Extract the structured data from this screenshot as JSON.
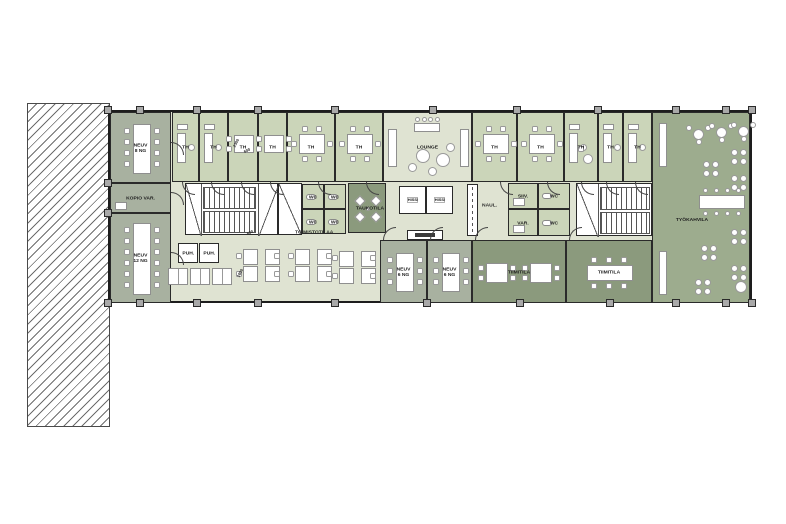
{
  "plan_title": "office-floor-plan",
  "palette": {
    "wall": "#1d1d1d",
    "meeting": "#a8b1a0",
    "office": "#cbd5b9",
    "open": "#dfe3d2",
    "dark": "#8b9a7d",
    "cafe": "#9dac8e",
    "white": "#ffffff",
    "furniture_line": "#8f8f8f"
  },
  "rooms": [
    {
      "id": "neuv-8",
      "label": "NEUV\n8 NG",
      "x": 110,
      "y": 112,
      "w": 61,
      "h": 71,
      "fill": "meeting",
      "furn": "vtable",
      "seats": 8,
      "door": "r"
    },
    {
      "id": "kopio-var",
      "label": "KOPIO VAR.",
      "x": 110,
      "y": 183,
      "w": 61,
      "h": 30,
      "fill": "meeting",
      "furn": "box",
      "door": "r"
    },
    {
      "id": "neuv-12",
      "label": "NEUV\n12 NG",
      "x": 110,
      "y": 213,
      "w": 61,
      "h": 90,
      "fill": "meeting",
      "furn": "vtable",
      "seats": 12,
      "door": "r"
    },
    {
      "id": "th-1",
      "label": "TH",
      "x": 172,
      "y": 112,
      "w": 27,
      "h": 70,
      "fill": "office",
      "furn": "desk",
      "door": "b"
    },
    {
      "id": "th-2",
      "label": "TH",
      "x": 199,
      "y": 112,
      "w": 29,
      "h": 70,
      "fill": "office",
      "furn": "desk",
      "door": "b"
    },
    {
      "id": "th-3",
      "label": "TH",
      "x": 228,
      "y": 112,
      "w": 30,
      "h": 70,
      "fill": "office",
      "furn": "table4",
      "door": "b"
    },
    {
      "id": "th-4",
      "label": "TH",
      "x": 258,
      "y": 112,
      "w": 29,
      "h": 70,
      "fill": "office",
      "furn": "table4",
      "door": "b"
    },
    {
      "id": "th-5",
      "label": "TH",
      "x": 287,
      "y": 112,
      "w": 48,
      "h": 70,
      "fill": "office",
      "furn": "table6",
      "door": "b"
    },
    {
      "id": "th-6",
      "label": "TH",
      "x": 335,
      "y": 112,
      "w": 48,
      "h": 70,
      "fill": "office",
      "furn": "table6",
      "door": "b"
    },
    {
      "id": "lounge",
      "label": "LOUNGE",
      "x": 383,
      "y": 112,
      "w": 89,
      "h": 70,
      "fill": "open",
      "furn": "lounge"
    },
    {
      "id": "th-7",
      "label": "TH",
      "x": 472,
      "y": 112,
      "w": 45,
      "h": 70,
      "fill": "office",
      "furn": "table6",
      "door": "b"
    },
    {
      "id": "th-8",
      "label": "TH",
      "x": 517,
      "y": 112,
      "w": 47,
      "h": 70,
      "fill": "office",
      "furn": "table6",
      "door": "b"
    },
    {
      "id": "th-9",
      "label": "TH",
      "x": 564,
      "y": 112,
      "w": 34,
      "h": 70,
      "fill": "office",
      "furn": "desk2",
      "door": "b"
    },
    {
      "id": "th-10",
      "label": "TH",
      "x": 598,
      "y": 112,
      "w": 25,
      "h": 70,
      "fill": "office",
      "furn": "desk",
      "door": "b"
    },
    {
      "id": "th-11",
      "label": "TH",
      "x": 623,
      "y": 112,
      "w": 29,
      "h": 70,
      "fill": "office",
      "furn": "desk",
      "door": "b"
    },
    {
      "id": "tyokahvila",
      "label": "TYÖKAHVILA",
      "x": 652,
      "y": 112,
      "w": 98,
      "h": 191,
      "fill": "cafe",
      "furn": "cafe",
      "labelPos": [
        6,
        102,
        66
      ]
    },
    {
      "id": "stairs-west",
      "label": "",
      "x": 185,
      "y": 183,
      "w": 93,
      "h": 52,
      "fill": "white",
      "furn": "stairsA"
    },
    {
      "id": "shaft",
      "label": "",
      "x": 278,
      "y": 183,
      "w": 24,
      "h": 52,
      "fill": "white",
      "furn": "slash"
    },
    {
      "id": "wc-1",
      "label": "WC",
      "x": 302,
      "y": 184,
      "w": 22,
      "h": 25,
      "fill": "office",
      "furn": "wcfix"
    },
    {
      "id": "wc-2",
      "label": "WC",
      "x": 324,
      "y": 184,
      "w": 22,
      "h": 25,
      "fill": "office",
      "furn": "wcfix"
    },
    {
      "id": "wc-3",
      "label": "WC",
      "x": 302,
      "y": 209,
      "w": 22,
      "h": 25,
      "fill": "office",
      "furn": "wcfix"
    },
    {
      "id": "wc-4",
      "label": "WC",
      "x": 324,
      "y": 209,
      "w": 22,
      "h": 25,
      "fill": "office",
      "furn": "wcfix"
    },
    {
      "id": "taukotila",
      "label": "TAUKOTILA",
      "x": 348,
      "y": 183,
      "w": 38,
      "h": 50,
      "fill": "dark",
      "furn": "xtable"
    },
    {
      "id": "hissi-1",
      "label": "HISSI",
      "x": 399,
      "y": 186,
      "w": 27,
      "h": 28,
      "fill": "white"
    },
    {
      "id": "hissi-2",
      "label": "HISSI",
      "x": 426,
      "y": 186,
      "w": 27,
      "h": 28,
      "fill": "white"
    },
    {
      "id": "info-sign",
      "label": "",
      "x": 407,
      "y": 230,
      "w": 36,
      "h": 10,
      "fill": "white",
      "furn": "sign"
    },
    {
      "id": "naulakko-rack",
      "label": "",
      "x": 467,
      "y": 184,
      "w": 11,
      "h": 52,
      "fill": "white",
      "furn": "vdash"
    },
    {
      "id": "siiv",
      "label": "SIIV.",
      "x": 508,
      "y": 183,
      "w": 30,
      "h": 26,
      "fill": "office",
      "furn": "box"
    },
    {
      "id": "var",
      "label": "VAR.",
      "x": 508,
      "y": 209,
      "w": 30,
      "h": 27,
      "fill": "office",
      "furn": "box"
    },
    {
      "id": "wc-5",
      "label": "WC",
      "x": 538,
      "y": 183,
      "w": 32,
      "h": 26,
      "fill": "office",
      "furn": "wcfix"
    },
    {
      "id": "wc-6",
      "label": "WC",
      "x": 538,
      "y": 209,
      "w": 32,
      "h": 27,
      "fill": "office",
      "furn": "wcfix"
    },
    {
      "id": "stairs-east",
      "label": "",
      "x": 576,
      "y": 183,
      "w": 76,
      "h": 53,
      "fill": "white",
      "furn": "stairsB"
    },
    {
      "id": "puh-1",
      "label": "PUH.",
      "x": 178,
      "y": 243,
      "w": 20,
      "h": 20,
      "fill": "white"
    },
    {
      "id": "puh-2",
      "label": "PUH.",
      "x": 199,
      "y": 243,
      "w": 20,
      "h": 20,
      "fill": "white"
    },
    {
      "id": "neuv-6a",
      "label": "NEUV\n6 NG",
      "x": 380,
      "y": 240,
      "w": 47,
      "h": 63,
      "fill": "meeting",
      "furn": "vtable",
      "seats": 6,
      "door": "t"
    },
    {
      "id": "neuv-6b",
      "label": "NEUV\n6 NG",
      "x": 427,
      "y": 240,
      "w": 45,
      "h": 63,
      "fill": "meeting",
      "furn": "vtable",
      "seats": 6,
      "door": "t"
    },
    {
      "id": "tiimitila-1",
      "label": "TIIMITILA",
      "x": 472,
      "y": 240,
      "w": 94,
      "h": 63,
      "fill": "dark",
      "furn": "twotables",
      "door": "t"
    },
    {
      "id": "tiimitila-2",
      "label": "TIIMITILA",
      "x": 566,
      "y": 240,
      "w": 86,
      "h": 63,
      "fill": "dark",
      "furn": "htable",
      "door": "t"
    }
  ],
  "open_office": {
    "clusters": [
      [
        236,
        249
      ],
      [
        288,
        249
      ],
      [
        332,
        251
      ]
    ],
    "lockers": [
      [
        168,
        268
      ],
      [
        190,
        268
      ],
      [
        212,
        268
      ]
    ]
  },
  "cafe_furniture": {
    "sofas": [
      [
        6,
        10,
        8,
        44
      ],
      [
        6,
        138,
        8,
        44
      ]
    ],
    "round3": [
      [
        40,
        16
      ],
      [
        63,
        14
      ],
      [
        85,
        13
      ]
    ],
    "x4": [
      [
        50,
        48
      ],
      [
        78,
        36
      ],
      [
        78,
        62
      ],
      [
        78,
        116
      ],
      [
        48,
        132
      ],
      [
        78,
        152
      ],
      [
        42,
        166
      ]
    ],
    "long_table": [
      46,
      82,
      46,
      14
    ],
    "big_chair": [
      82,
      168
    ]
  },
  "annotations": [
    {
      "t": "TOIMISTOTILAA",
      "x": 295,
      "y": 229,
      "r": 0,
      "s": 0.62
    },
    {
      "t": "NAUL.",
      "x": 482,
      "y": 202,
      "r": 0,
      "s": 0.62
    },
    {
      "t": "2300",
      "x": 232,
      "y": 146,
      "r": -62,
      "s": 0.5
    },
    {
      "t": "600",
      "x": 243,
      "y": 150,
      "r": -25,
      "s": 0.5
    },
    {
      "t": "1600",
      "x": 236,
      "y": 276,
      "r": -62,
      "s": 0.5
    },
    {
      "t": "600",
      "x": 246,
      "y": 232,
      "r": -25,
      "s": 0.5
    }
  ],
  "structure": {
    "columns_top_x": [
      108,
      140,
      197,
      258,
      335,
      433,
      517,
      598,
      676,
      726,
      752
    ],
    "columns_bottom_x": [
      108,
      140,
      197,
      258,
      335,
      427,
      520,
      610,
      676,
      726,
      752
    ],
    "columns_left_y": [
      183,
      213
    ]
  }
}
